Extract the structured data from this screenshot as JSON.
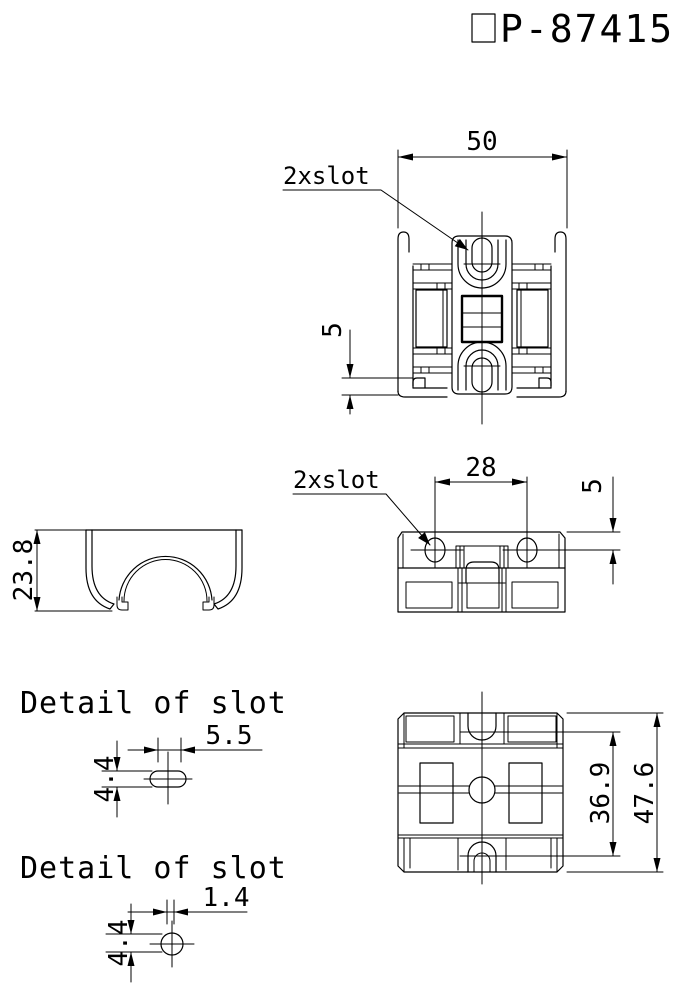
{
  "title": {
    "leading_symbol": "rectangle-box-glyph",
    "text": "P-87415"
  },
  "views": {
    "top": {
      "width": "50",
      "step": "5",
      "callout": "2xslot"
    },
    "side": {
      "height": "23.8"
    },
    "front": {
      "spacing": "28",
      "offset": "5",
      "callout": "2xslot"
    },
    "bottom": {
      "inner": "36.9",
      "overall": "47.6"
    }
  },
  "details": {
    "d1": {
      "heading": "Detail of slot",
      "length": "5.5",
      "height": "4.4"
    },
    "d2": {
      "heading": "Detail of slot",
      "width": "1.4",
      "height": "4.4"
    }
  },
  "colors": {
    "line": "#000000",
    "background": "#ffffff"
  }
}
